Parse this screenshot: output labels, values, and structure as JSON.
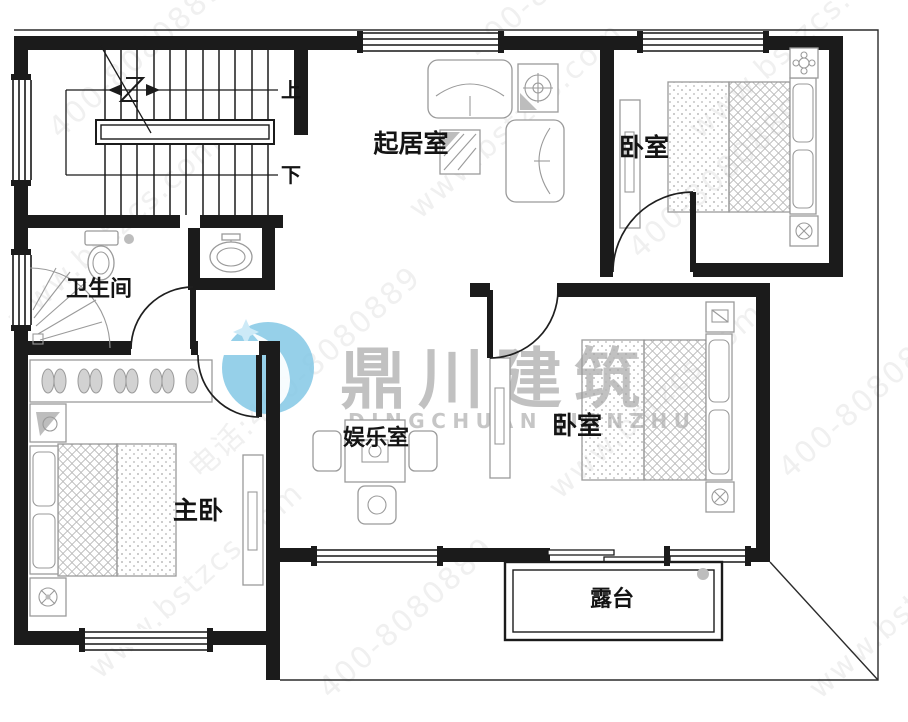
{
  "rooms": {
    "living": {
      "label": "起居室"
    },
    "bedroom_top": {
      "label": "卧室"
    },
    "bathroom": {
      "label": "卫生间"
    },
    "master": {
      "label": "主卧"
    },
    "entertainment": {
      "label": "娱乐室"
    },
    "bedroom_mid": {
      "label": "卧室"
    },
    "terrace": {
      "label": "露台"
    }
  },
  "stairs": {
    "up_label": "上",
    "down_label": "下"
  },
  "watermark": {
    "brand": "鼎川建筑",
    "brand_latin": "DINGCHUAN JIANZHU",
    "site": "www.bstzcs.com",
    "phone": "400-8080889",
    "phone_label": "电话:400-8080889"
  },
  "colors": {
    "wall": "#1b1b1b",
    "furniture_line": "#9a9a9a",
    "logo_blue": "#7fc6e4",
    "watermark_text": "#8f8f8f",
    "accent_dot": "#bdbdbd"
  }
}
